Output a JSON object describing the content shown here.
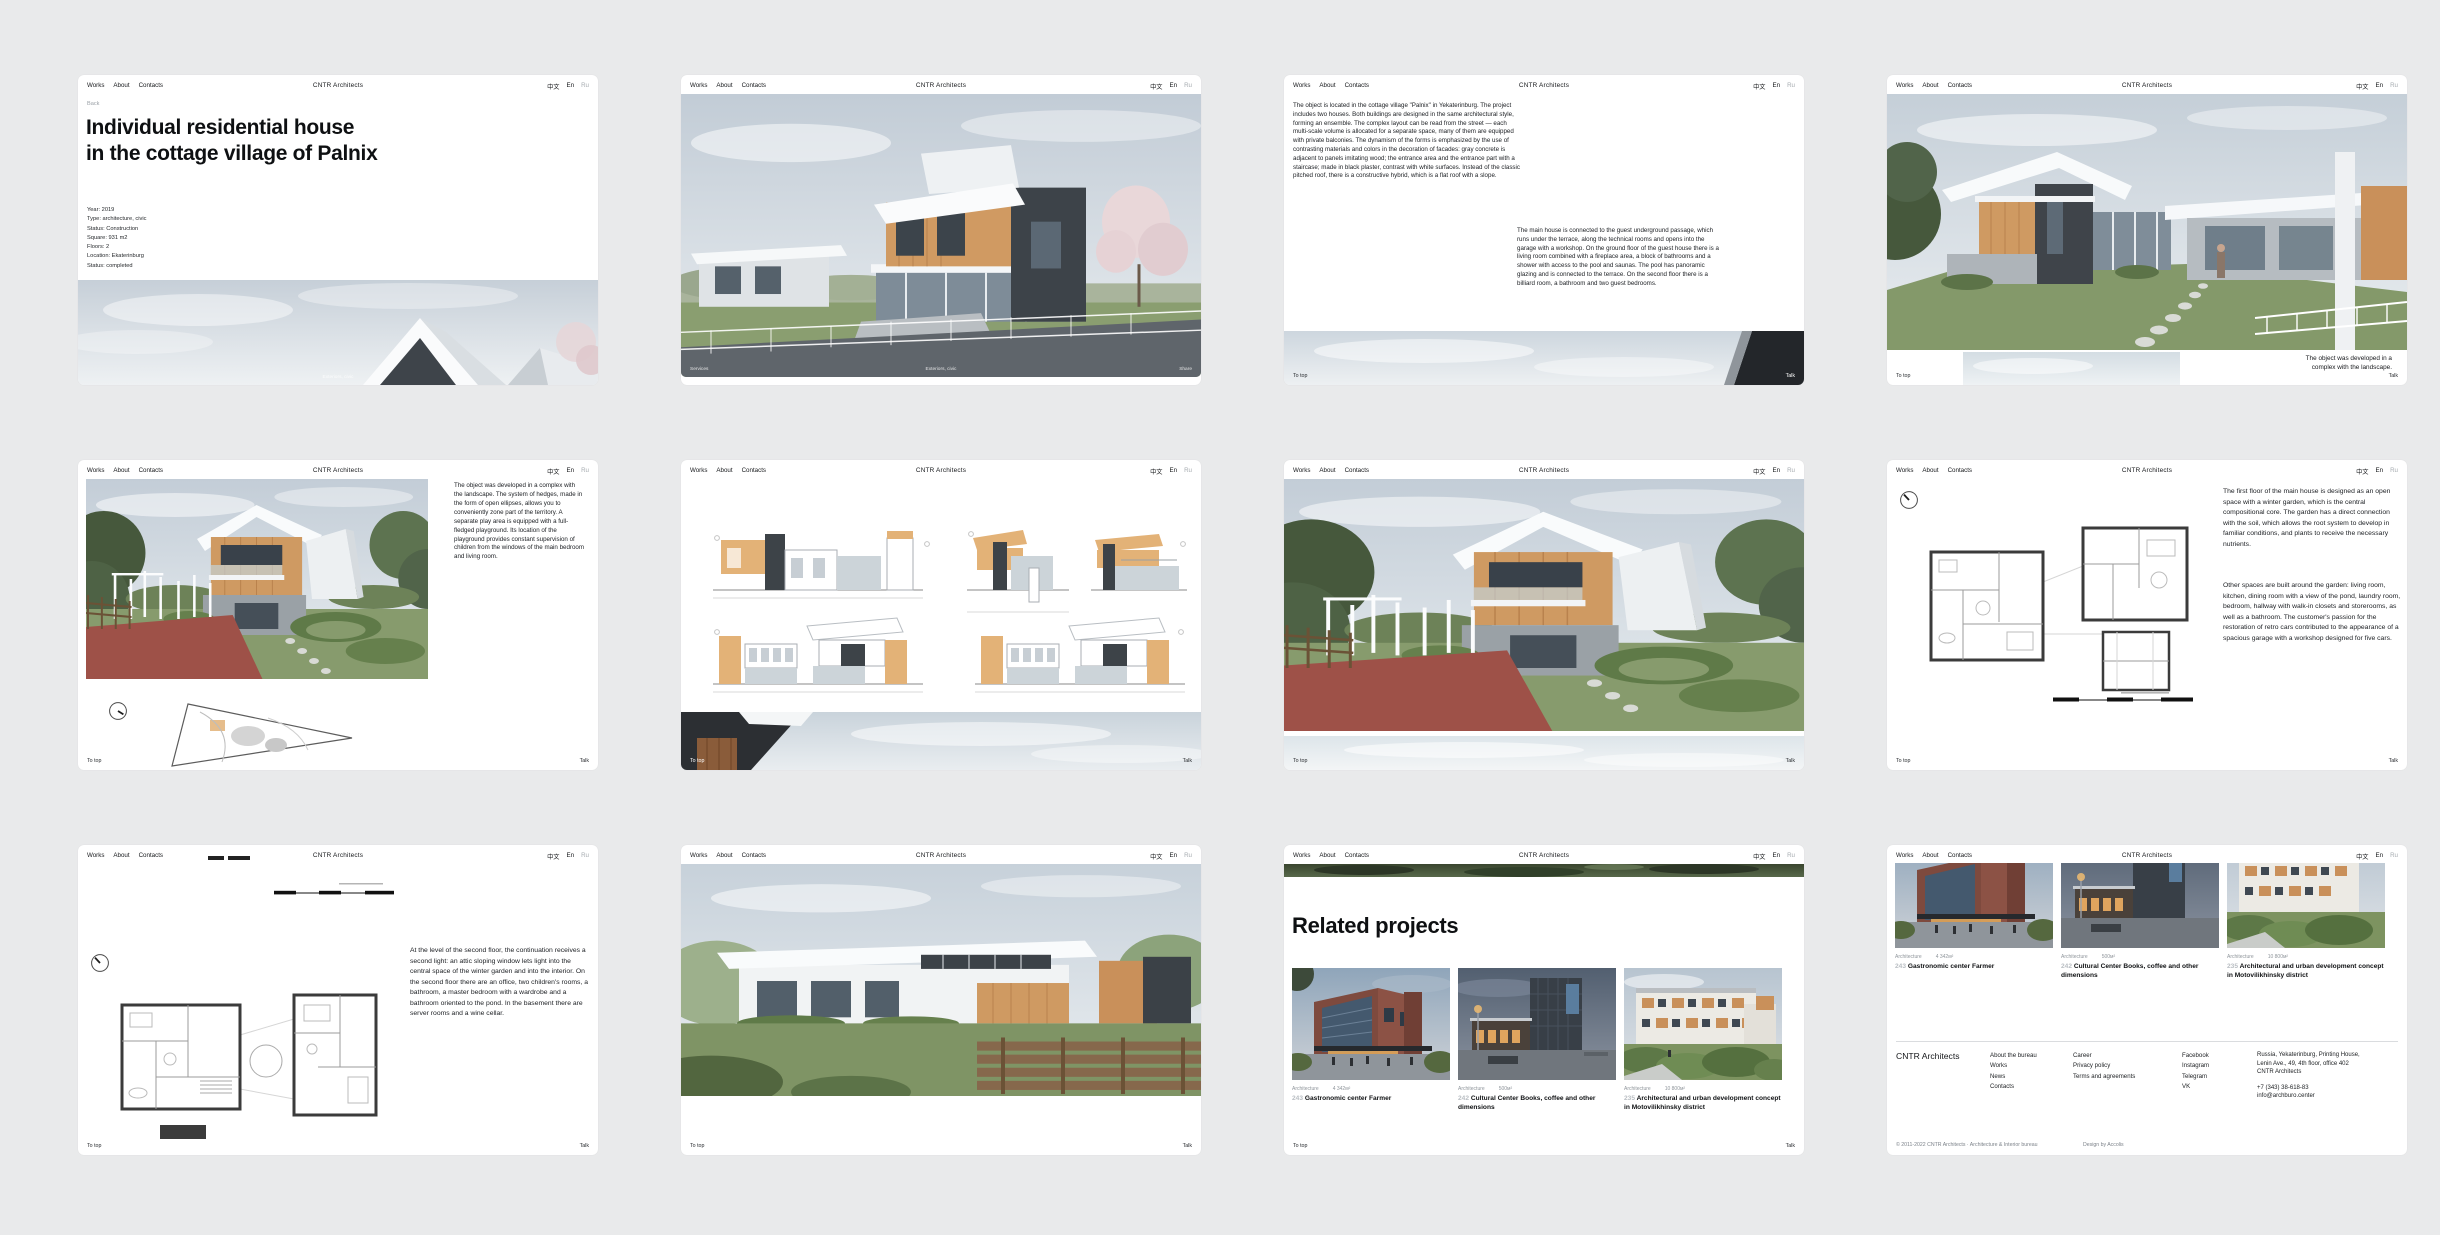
{
  "brand": "CNTR Architects",
  "nav": {
    "links": [
      "Works",
      "About",
      "Contacts"
    ],
    "languages": [
      "中文",
      "En",
      "Ru"
    ]
  },
  "pagebar": {
    "to_top": "To top",
    "talk": "Talk"
  },
  "project": {
    "back": "Back",
    "title_line1": "Individual residential house",
    "title_line2": "in the cottage village of Palnix",
    "meta": [
      "Year: 2019",
      "Type: architecture, civic",
      "Status: Construction",
      "Square: 931 m2",
      "Floors: 2",
      "Location: Ekaterinburg",
      "Status: completed"
    ],
    "hero_overlay": {
      "left": "Services",
      "center": "Exteriors, civic",
      "right": "Share"
    },
    "text_location": "The object is located in the cottage village \"Palnix\" in Yekaterinburg. The project includes two houses. Both buildings are designed in the same architectural style, forming an ensemble. The complex layout can be read from the street — each multi-scale volume is allocated for a separate space, many of them are equipped with private balconies. The dynamism of the forms is emphasized by the use of contrasting materials and colors in the decoration of facades: gray concrete is adjacent to panels imitating wood; the entrance area and the entrance part with a staircase; made in black plaster, contrast with white surfaces. Instead of the classic pitched roof, there is a constructive hybrid, which is a flat roof with a slope.",
    "text_guest_house": "The main house is connected to the guest underground passage, which runs under the terrace, along the technical rooms and opens into the garage with a workshop. On the ground floor of the guest house there is a living room combined with a fireplace area, a block of bathrooms and a shower with access to the pool and saunas. The pool has panoramic glazing and is connected to the terrace. On the second floor there is a billiard room, a bathroom and two guest bedrooms.",
    "caption_landscape": "The object was developed in a complex with the landscape.",
    "text_landscape": "The object was developed in a complex with the landscape. The system of hedges, made in the form of open ellipses, allows you to conveniently zone part of the territory. A separate play area is equipped with a full-fledged playground. Its location of the playground provides constant supervision of children from the windows of the main bedroom and living room.",
    "text_first_floor_1": "The first floor of the main house is designed as an open space with a winter garden, which is the central compositional core. The garden has a direct connection with the soil, which allows the root system to develop in familiar conditions, and plants to receive the necessary nutrients.",
    "text_first_floor_2": "Other spaces are built around the garden: living room, kitchen, dining room with a view of the pond, laundry room, bedroom, hallway with walk-in closets and storerooms, as well as a bathroom. The customer's passion for the restoration of retro cars contributed to the appearance of a spacious garage with a workshop designed for five cars.",
    "text_second_floor": "At the level of the second floor, the continuation receives a second light: an attic sloping window lets light into the central space of the winter garden and into the interior. On the second floor there are an office, two children's rooms, a bathroom, a master bedroom with a wardrobe and a bathroom oriented to the pond. In the basement there are server rooms and a wine cellar."
  },
  "related": {
    "heading": "Related projects",
    "cards": [
      {
        "number": "243",
        "category": "Architecture",
        "area": "4 342м²",
        "title": "Gastronomic center Farmer"
      },
      {
        "number": "242",
        "category": "Architecture",
        "area": "500м²",
        "title": "Cultural Center Books, coffee and other dimensions"
      },
      {
        "number": "235",
        "category": "Architecture",
        "area": "10 800м²",
        "title": "Architectural and urban development concept in Motovilikhinsky district"
      }
    ]
  },
  "site_footer": {
    "columns": [
      [
        "About the bureau",
        "Works",
        "News",
        "Contacts"
      ],
      [
        "Career",
        "Privacy policy",
        "Terms and agreements"
      ],
      [
        "Facebook",
        "Instagram",
        "Telegram",
        "VK"
      ]
    ],
    "address_lines": [
      "Russia, Yekaterinburg, Printing House,",
      "Lenin Ave., 49, 4th floor, office 402",
      "CNTR Architects"
    ],
    "phone": "+7 (343) 38-618-83",
    "email": "info@archburo.center",
    "copyright": "© 2011-2022 CNTR Architects · Architecture & Interior bureau",
    "credit": "Design by Accolis"
  }
}
